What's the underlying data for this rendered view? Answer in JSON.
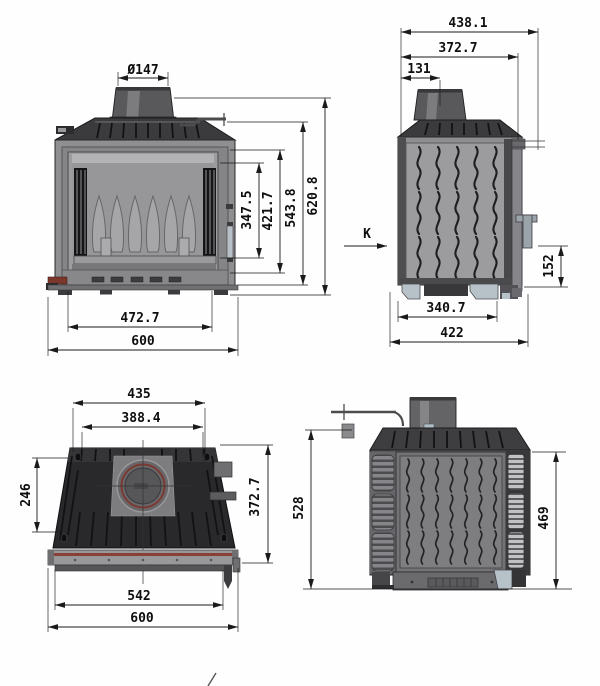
{
  "drawing_title": "fireplace insert technical drawing, four orthographic views",
  "colors": {
    "drawing_line": "#1a1a1a",
    "body_gray": "#8f8f91",
    "dark_casting_gray": "#3b3b3d",
    "accent_ring_red": "#7b3a33",
    "front_bar_stripe_red": "#8a4036",
    "name_plate_red": "#7c372c",
    "feet_blue_gray": "#b7c1c8"
  },
  "views": {
    "front": {
      "label": "front view",
      "dims": {
        "flue_diameter": "Ø147",
        "opening_height": "347.5",
        "glass_height": "421.7",
        "body_height": "543.8",
        "total_height": "620.8",
        "opening_width": "472.7",
        "total_width": "600"
      }
    },
    "side": {
      "label": "side view",
      "section_marker": "K",
      "dims": {
        "total_depth": "438.1",
        "flue_center_from_rear": "372.7",
        "flue_center_offset": "131",
        "handle_height": "152",
        "base_depth": "340.7",
        "overall_depth": "422"
      }
    },
    "top": {
      "label": "top view",
      "dims": {
        "body_top_width": "435",
        "inner_top_width": "388.4",
        "top_plate_depth": "246",
        "overall_depth": "372.7",
        "front_bar_width": "542",
        "total_width": "600"
      }
    },
    "rear": {
      "label": "rear view",
      "dims": {
        "total_height": "528",
        "body_height": "469"
      }
    }
  }
}
